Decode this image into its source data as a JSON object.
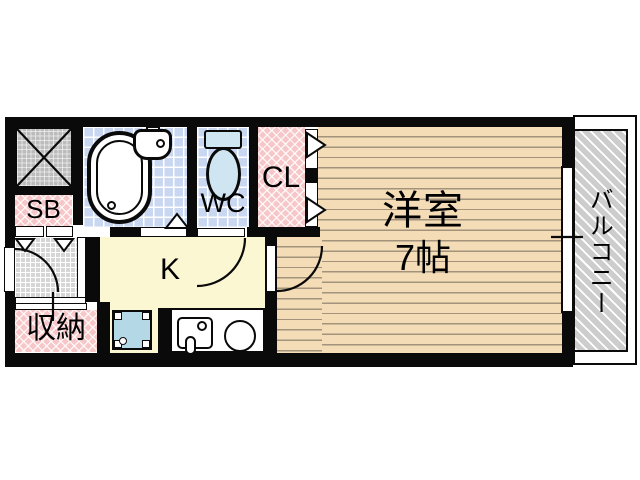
{
  "plan": {
    "rooms": {
      "western_room": {
        "name_label": "洋室",
        "size_label": "7帖"
      },
      "kitchen": {
        "label": "K"
      },
      "balcony": {
        "label": "バルコニー"
      },
      "closet": {
        "label": "CL"
      },
      "toilet": {
        "label": "WC"
      },
      "shoe_box": {
        "label": "SB"
      },
      "storage": {
        "label": "収納"
      }
    },
    "fixtures": {
      "bathtub": "bathtub",
      "washbasin": "washbasin",
      "toilet_bowl": "toilet",
      "kitchen_sink": "kitchen-sink",
      "stove_burner": "stove-burner",
      "washing_machine_pan": "washing-machine-pan",
      "pipe_shaft": "pipe-shaft"
    },
    "colors": {
      "wall": "#0a0a0a",
      "room_floor": "#f3dcb6",
      "kitchen_floor": "#fbf7d3",
      "tile_blue": "#c9d7f0",
      "closet_pink": "#f7c6c8",
      "balcony_gray": "#cdcdcd",
      "entrance_gray": "#d6d6d6",
      "shaft_gray": "#bcbcbc",
      "washing_pan_blue": "#b4d8e6",
      "porcelain_blue": "#cfe6f2"
    }
  }
}
